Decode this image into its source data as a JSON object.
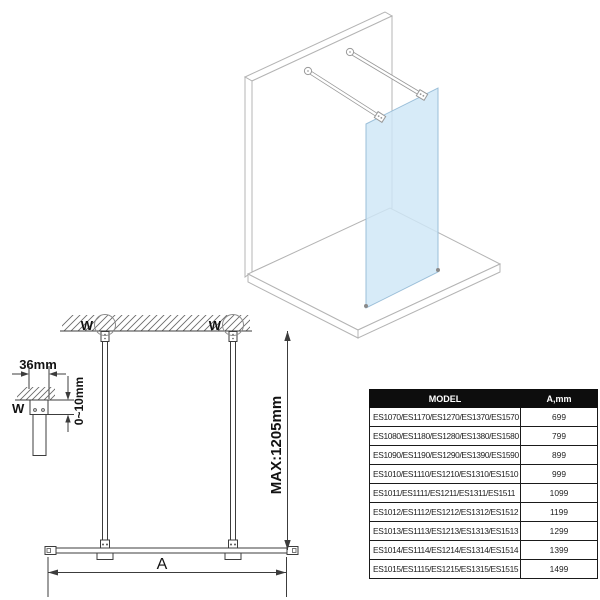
{
  "labels": {
    "wall_mount_left": "W",
    "wall_mount_right": "W",
    "wall_mount_detail": "W",
    "bracket_width": "36mm",
    "ceiling_gap": "0~10mm",
    "max_bar_length": "MAX:1205mm",
    "glass_width": "A"
  },
  "colors": {
    "glass": "#cee6f7",
    "glass_edge": "#9bbfd9",
    "iso_outline": "#b4b4b4",
    "drawing_line": "#3c3c3c",
    "table_header_bg": "#0d0d0d",
    "table_header_text": "#ffffff"
  },
  "table": {
    "columns": [
      "MODEL",
      "A,mm"
    ],
    "rows": [
      {
        "model": "ES1070/ES1170/ES1270/ES1370/ES1570",
        "a_mm": "699"
      },
      {
        "model": "ES1080/ES1180/ES1280/ES1380/ES1580",
        "a_mm": "799"
      },
      {
        "model": "ES1090/ES1190/ES1290/ES1390/ES1590",
        "a_mm": "899"
      },
      {
        "model": "ES1010/ES1110/ES1210/ES1310/ES1510",
        "a_mm": "999"
      },
      {
        "model": "ES1011/ES1111/ES1211/ES1311/ES1511",
        "a_mm": "1099"
      },
      {
        "model": "ES1012/ES1112/ES1212/ES1312/ES1512",
        "a_mm": "1199"
      },
      {
        "model": "ES1013/ES1113/ES1213/ES1313/ES1513",
        "a_mm": "1299"
      },
      {
        "model": "ES1014/ES1114/ES1214/ES1314/ES1514",
        "a_mm": "1399"
      },
      {
        "model": "ES1015/ES1115/ES1215/ES1315/ES1515",
        "a_mm": "1499"
      }
    ]
  }
}
